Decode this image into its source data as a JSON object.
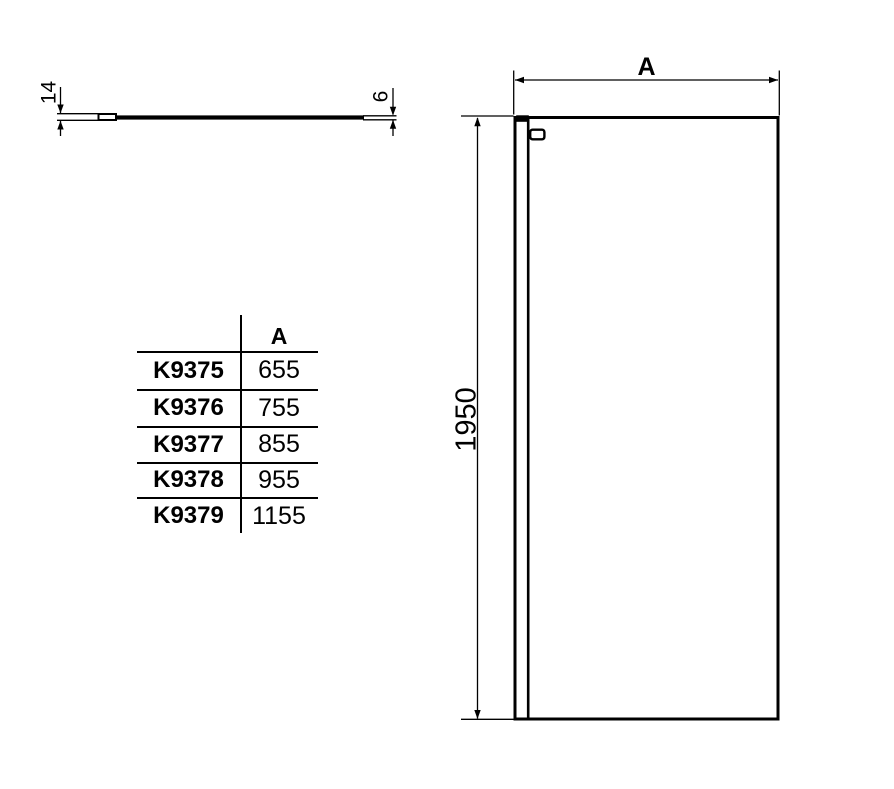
{
  "drawing": {
    "top_view": {
      "profile_depth": "14",
      "glass_thickness": "6"
    },
    "front_view": {
      "width_dim": "A",
      "height_dim": "1950"
    }
  },
  "spec_table": {
    "header_width": "A",
    "rows": [
      {
        "model": "K9375",
        "width": "655"
      },
      {
        "model": "K9376",
        "width": "755"
      },
      {
        "model": "K9377",
        "width": "855"
      },
      {
        "model": "K9378",
        "width": "955"
      },
      {
        "model": "K9379",
        "width": "1155"
      }
    ]
  },
  "colors": {
    "line": "#000000",
    "background": "#ffffff"
  }
}
